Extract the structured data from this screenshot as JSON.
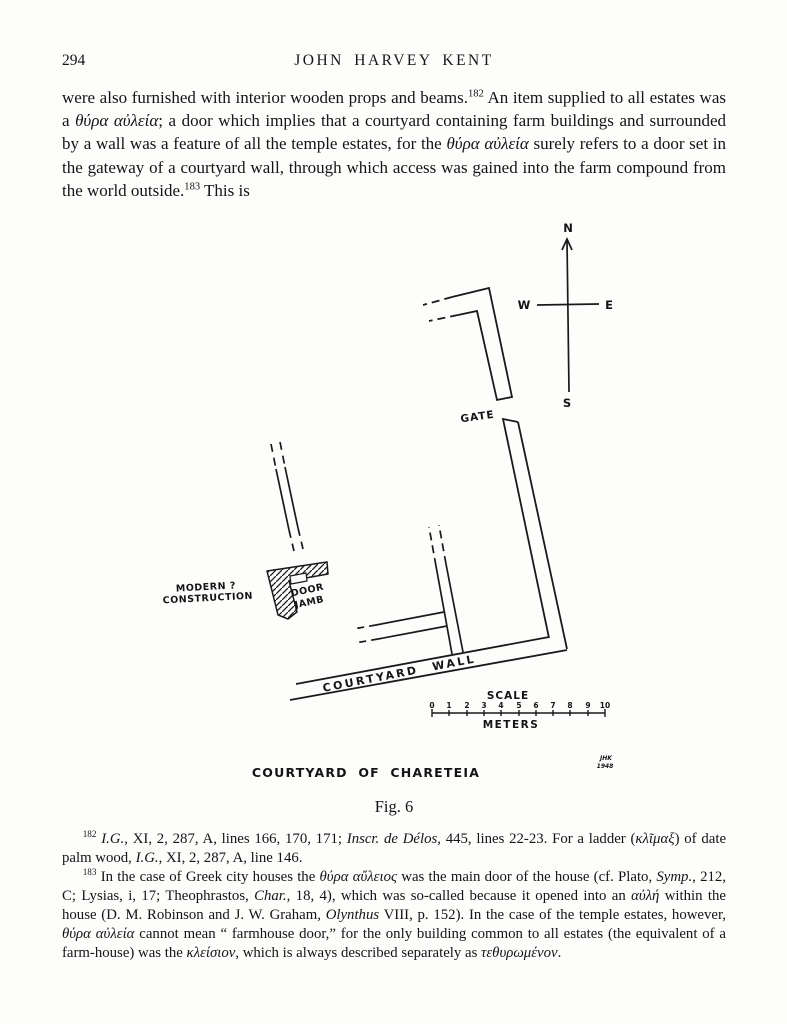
{
  "header": {
    "page_number": "294",
    "running_title": "JOHN HARVEY KENT"
  },
  "body": {
    "paragraph_segments": [
      {
        "text": "were also furnished with interior wooden props and beams.",
        "style": "normal"
      },
      {
        "text": "182",
        "style": "sup"
      },
      {
        "text": " An item supplied to all estates was a ",
        "style": "normal"
      },
      {
        "text": "θύρα αὐλεία",
        "style": "italic"
      },
      {
        "text": "; a door which implies that a courtyard containing farm buildings and surrounded by a wall was a feature of all the temple estates, for the ",
        "style": "normal"
      },
      {
        "text": "θύρα αὐλεία",
        "style": "italic"
      },
      {
        "text": " surely refers to a door set in the gateway of a courtyard wall, through which access was gained into the farm compound from the world outside.",
        "style": "normal"
      },
      {
        "text": "183",
        "style": "sup"
      },
      {
        "text": " This is",
        "style": "normal"
      }
    ]
  },
  "figure": {
    "compass": {
      "north": "N",
      "south": "S",
      "east": "E",
      "west": "W"
    },
    "labels": {
      "gate": "GATE",
      "modern_line1": "MODERN ?",
      "modern_line2": "CONSTRUCTION",
      "door_jamb_line1": "DOOR",
      "door_jamb_line2": "JAMB",
      "courtyard_wall": "COURTYARD  WALL"
    },
    "scale": {
      "title": "SCALE",
      "unit": "METERS",
      "ticks": [
        "0",
        "1",
        "2",
        "3",
        "4",
        "5",
        "6",
        "7",
        "8",
        "9",
        "10"
      ]
    },
    "caption": "COURTYARD OF CHARETEIA",
    "signature_line1": "JHK",
    "signature_line2": "1948",
    "figure_number": "Fig. 6",
    "line_color": "#1a1a1a"
  },
  "footnotes": [
    {
      "segments": [
        {
          "text": "182",
          "style": "sup"
        },
        {
          "text": " ",
          "style": "normal"
        },
        {
          "text": "I.G.",
          "style": "italic"
        },
        {
          "text": ", XI, 2, 287, A, lines 166, 170, 171; ",
          "style": "normal"
        },
        {
          "text": "Inscr. de Délos",
          "style": "italic"
        },
        {
          "text": ", 445, lines 22-23.  For a ladder (",
          "style": "normal"
        },
        {
          "text": "κλῖμαξ",
          "style": "italic"
        },
        {
          "text": ") of date palm wood, ",
          "style": "normal"
        },
        {
          "text": "I.G.",
          "style": "italic"
        },
        {
          "text": ", XI, 2, 287, A, line 146.",
          "style": "normal"
        }
      ]
    },
    {
      "segments": [
        {
          "text": "183",
          "style": "sup"
        },
        {
          "text": " In the case of Greek city houses the ",
          "style": "normal"
        },
        {
          "text": "θύρα αὔλειος",
          "style": "italic"
        },
        {
          "text": " was the main door of the house (cf. Plato, ",
          "style": "normal"
        },
        {
          "text": "Symp.",
          "style": "italic"
        },
        {
          "text": ", 212, C; Lysias, i, 17; Theophrastos, ",
          "style": "normal"
        },
        {
          "text": "Char.",
          "style": "italic"
        },
        {
          "text": ", 18, 4), which was so-called because it opened into an ",
          "style": "normal"
        },
        {
          "text": "αὐλή",
          "style": "italic"
        },
        {
          "text": " within the house (D. M. Robinson and J. W. Graham, ",
          "style": "normal"
        },
        {
          "text": "Olynthus",
          "style": "italic"
        },
        {
          "text": " VIII, p. 152).  In the case of the temple estates, however, ",
          "style": "normal"
        },
        {
          "text": "θύρα αὐλεία",
          "style": "italic"
        },
        {
          "text": " cannot mean “ farmhouse door,” for the only building common to all estates (the equivalent of a farm-house) was the ",
          "style": "normal"
        },
        {
          "text": "κλείσιον",
          "style": "italic"
        },
        {
          "text": ", which is always described separately as ",
          "style": "normal"
        },
        {
          "text": "τεθυρωμένον",
          "style": "italic"
        },
        {
          "text": ".",
          "style": "normal"
        }
      ]
    }
  ]
}
